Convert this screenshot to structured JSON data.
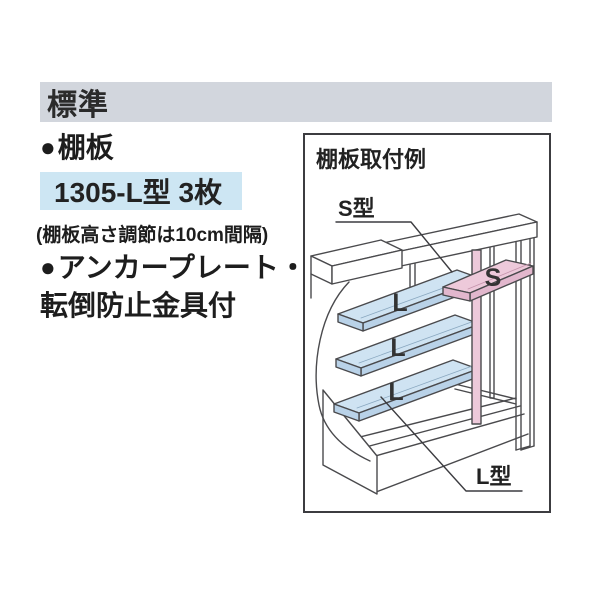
{
  "section_header": {
    "label": "標準",
    "bg": "#d2d6dd"
  },
  "shelf": {
    "bullet": "●",
    "title": "棚板",
    "spec": "1305-L型 3枚",
    "spec_bg": "#cde6f3",
    "note": "(棚板高さ調節は10cm間隔)"
  },
  "anchor": {
    "bullet": "●",
    "line1": "アンカープレート・",
    "line2": "転倒防止金具付"
  },
  "diagram": {
    "title": "棚板取付例",
    "s_label": "S型",
    "l_label": "L型",
    "s_letter": "S",
    "l_letter": "L",
    "colors": {
      "s_shelf": "#edc9da",
      "s_shelf_edge": "#e2b7cd",
      "l_shelf": "#cfe3f2",
      "l_shelf_edge": "#b9d2e8",
      "post": "#edc9da",
      "line": "#4a4a4d"
    }
  }
}
